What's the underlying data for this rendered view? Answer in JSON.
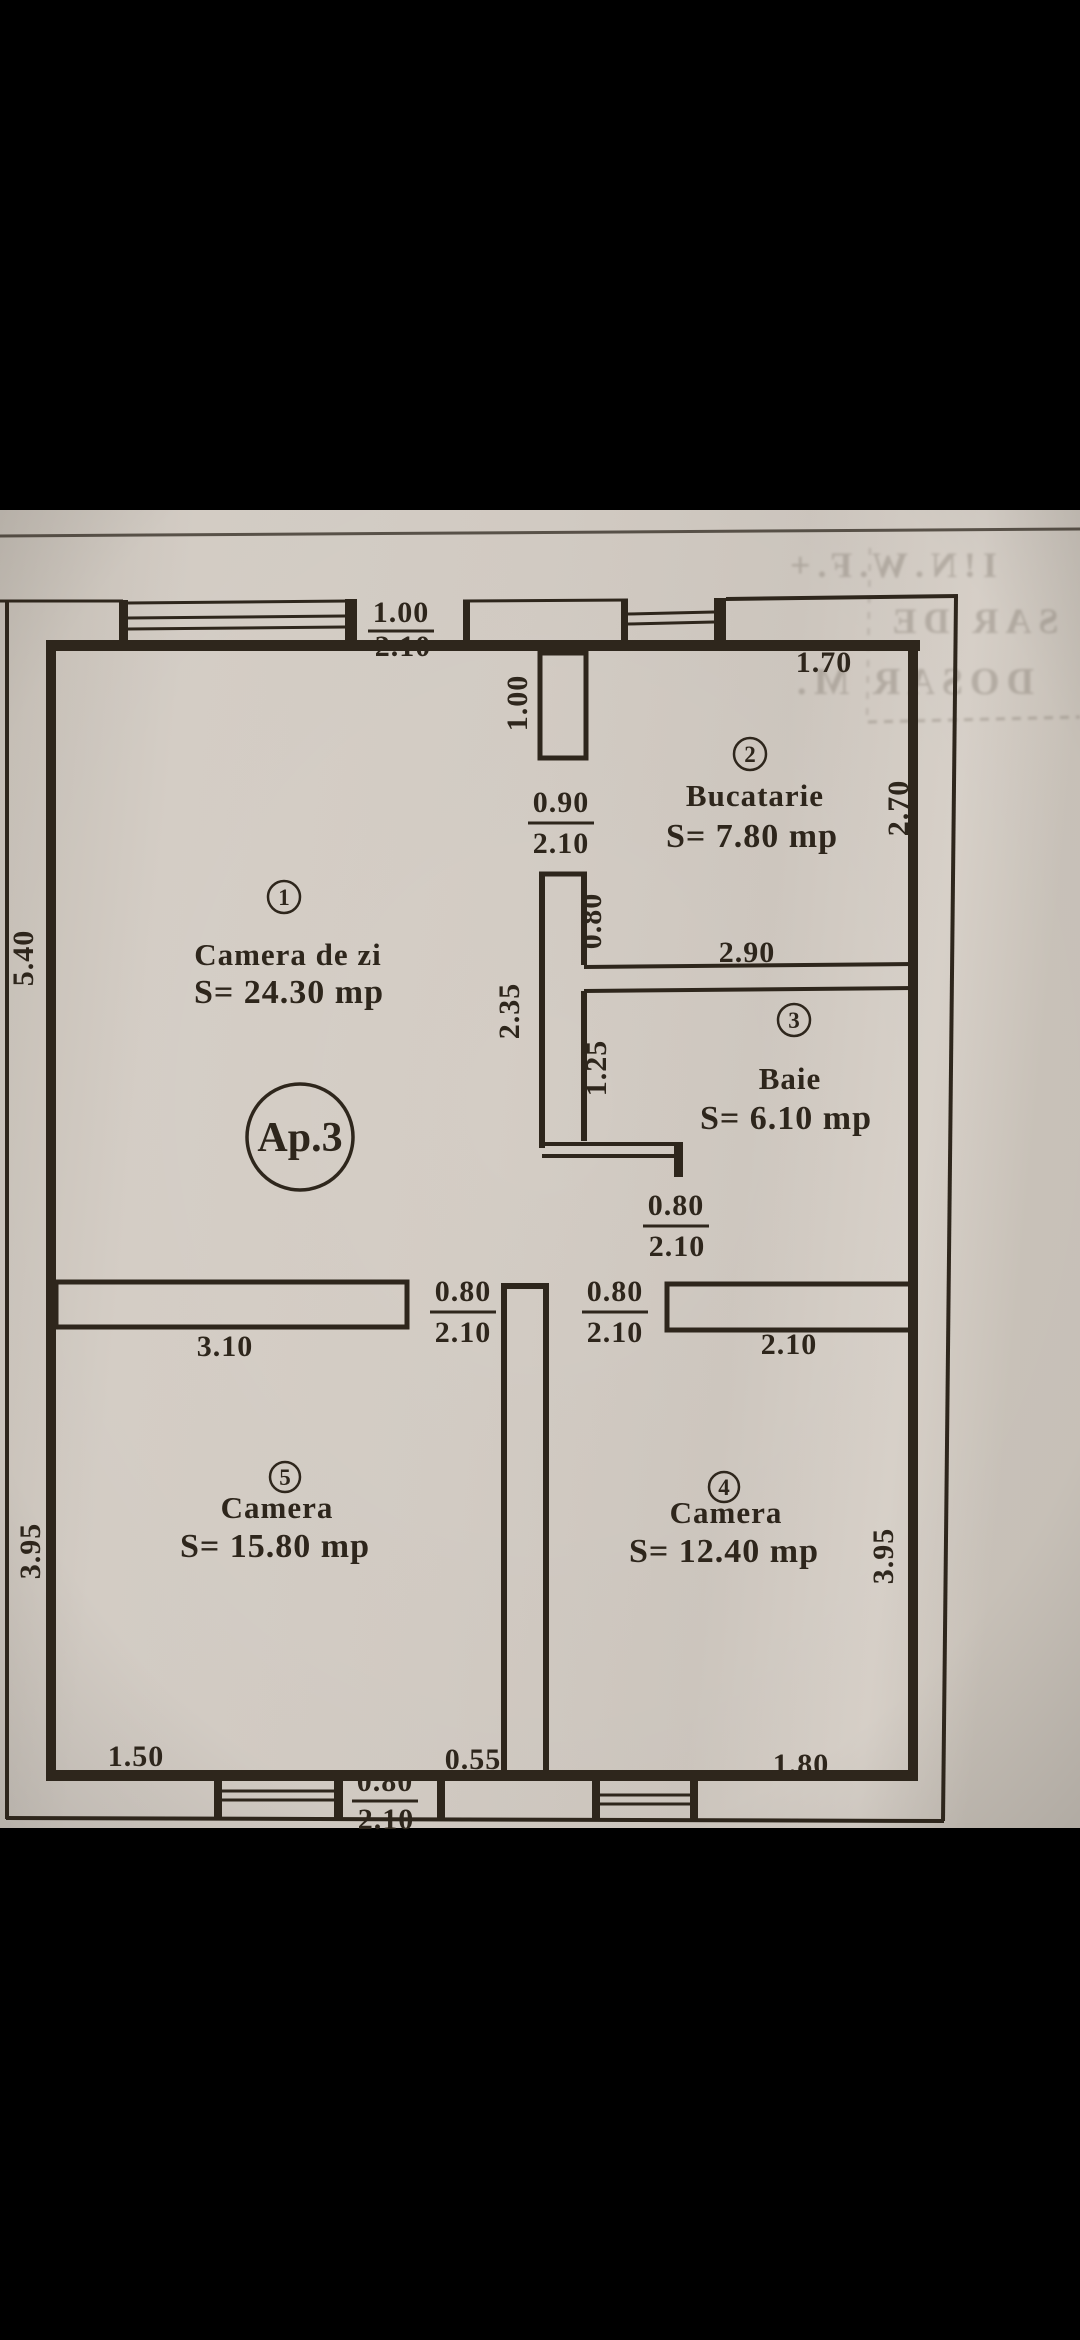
{
  "photo": {
    "kind": "scanned floor plan photo",
    "colors": {
      "paper": "#d4cdc5",
      "ink": "#2e261c",
      "letterbox": "#000000"
    }
  },
  "apartment": {
    "badge": "Ap.3"
  },
  "rooms": [
    {
      "no": "1",
      "name": "Camera de zi",
      "area": "S= 24.30 mp"
    },
    {
      "no": "2",
      "name": "Bucatarie",
      "area": "S= 7.80 mp"
    },
    {
      "no": "3",
      "name": "Baie",
      "area": "S= 6.10 mp"
    },
    {
      "no": "4",
      "name": "Camera",
      "area": "S= 12.40 mp"
    },
    {
      "no": "5",
      "name": "Camera",
      "area": "S= 15.80 mp"
    }
  ],
  "dims": {
    "top_door_w": "1.00",
    "top_door_h": "2.10",
    "kitchen_top": "1.70",
    "kitchen_right": "2.70",
    "wall_stub": "1.00",
    "int_door_w": "0.90",
    "int_door_h": "2.10",
    "wall_seg": "0.80",
    "living_wall": "2.35",
    "kitchen_width": "2.90",
    "bath_wall": "1.25",
    "bath_door_w": "0.80",
    "bath_door_h": "2.10",
    "left_wall": "5.40",
    "room5_door_w": "0.80",
    "room5_door_h": "2.10",
    "room4_door_w": "0.80",
    "room4_door_h": "2.10",
    "room5_top": "3.10",
    "hall_right": "2.10",
    "room5_left": "3.95",
    "room4_right": "3.95",
    "bottom_left": "1.50",
    "bottom_mid": "0.55",
    "bottom_right": "1.80",
    "bottom_door_w": "0.80",
    "bottom_door_h": "2.10"
  },
  "bleed_text": {
    "row1": "I!N.W.F.+",
    "row2": "SAR DE",
    "row3": "DOSAR M."
  }
}
